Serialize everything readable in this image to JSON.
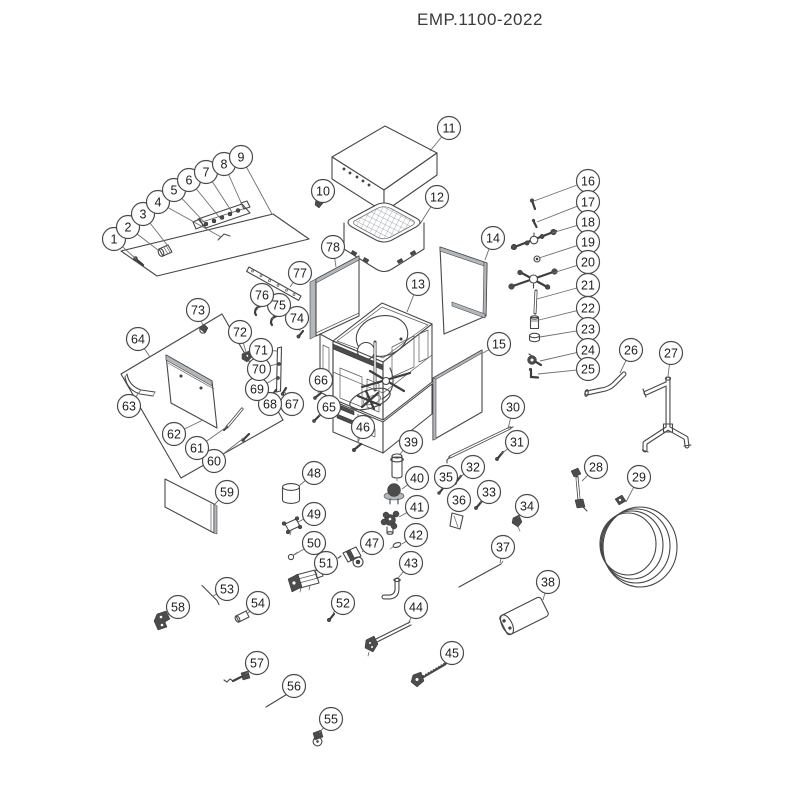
{
  "title": "EMP.1100-2022",
  "diagram": {
    "style": {
      "line_color": "#474747",
      "leader_color": "#6e6e6e",
      "circle_fill": "#ffffff",
      "circle_stroke": "#4a4a4a",
      "number_color": "#1d1d1d",
      "circle_radius": 11.5
    },
    "callouts": [
      {
        "n": "1",
        "x": 114,
        "y": 239,
        "tx": 136,
        "ty": 259
      },
      {
        "n": "2",
        "x": 128,
        "y": 227,
        "tx": 158,
        "ty": 250
      },
      {
        "n": "3",
        "x": 143,
        "y": 214,
        "tx": 168,
        "ty": 246
      },
      {
        "n": "4",
        "x": 158,
        "y": 202,
        "tx": 221,
        "ty": 237
      },
      {
        "n": "5",
        "x": 174,
        "y": 190,
        "tx": 205,
        "ty": 223
      },
      {
        "n": "6",
        "x": 189,
        "y": 180,
        "tx": 220,
        "ty": 218
      },
      {
        "n": "7",
        "x": 206,
        "y": 172,
        "tx": 232,
        "ty": 212
      },
      {
        "n": "8",
        "x": 224,
        "y": 164,
        "tx": 243,
        "ty": 207
      },
      {
        "n": "9",
        "x": 241,
        "y": 157,
        "tx": 272,
        "ty": 214
      },
      {
        "n": "10",
        "x": 323,
        "y": 191,
        "tx": 319,
        "ty": 200
      },
      {
        "n": "11",
        "x": 449,
        "y": 128,
        "tx": 430,
        "ty": 151
      },
      {
        "n": "12",
        "x": 437,
        "y": 197,
        "tx": 420,
        "ty": 224
      },
      {
        "n": "13",
        "x": 418,
        "y": 284,
        "tx": 407,
        "ty": 312
      },
      {
        "n": "14",
        "x": 493,
        "y": 238,
        "tx": 485,
        "ty": 260
      },
      {
        "n": "15",
        "x": 499,
        "y": 344,
        "tx": 483,
        "ty": 353
      },
      {
        "n": "16",
        "x": 588,
        "y": 181,
        "tx": 534,
        "ty": 201
      },
      {
        "n": "17",
        "x": 588,
        "y": 202,
        "tx": 537,
        "ty": 222
      },
      {
        "n": "18",
        "x": 588,
        "y": 222,
        "tx": 552,
        "ty": 233
      },
      {
        "n": "19",
        "x": 588,
        "y": 242,
        "tx": 539,
        "ty": 258
      },
      {
        "n": "20",
        "x": 588,
        "y": 262,
        "tx": 553,
        "ty": 273
      },
      {
        "n": "21",
        "x": 588,
        "y": 285,
        "tx": 537,
        "ty": 299
      },
      {
        "n": "22",
        "x": 588,
        "y": 308,
        "tx": 539,
        "ty": 320
      },
      {
        "n": "23",
        "x": 588,
        "y": 329,
        "tx": 540,
        "ty": 337
      },
      {
        "n": "24",
        "x": 588,
        "y": 350,
        "tx": 540,
        "ty": 361
      },
      {
        "n": "25",
        "x": 588,
        "y": 369,
        "tx": 538,
        "ty": 374
      },
      {
        "n": "26",
        "x": 631,
        "y": 350,
        "tx": 620,
        "ty": 373
      },
      {
        "n": "27",
        "x": 671,
        "y": 353,
        "tx": 668,
        "ty": 376
      },
      {
        "n": "28",
        "x": 596,
        "y": 467,
        "tx": 582,
        "ty": 481
      },
      {
        "n": "29",
        "x": 639,
        "y": 477,
        "tx": 626,
        "ty": 502
      },
      {
        "n": "30",
        "x": 513,
        "y": 407,
        "tx": 508,
        "ty": 429
      },
      {
        "n": "31",
        "x": 517,
        "y": 442,
        "tx": 501,
        "ty": 454
      },
      {
        "n": "32",
        "x": 473,
        "y": 467,
        "tx": 459,
        "ty": 478
      },
      {
        "n": "33",
        "x": 489,
        "y": 492,
        "tx": 480,
        "ty": 503
      },
      {
        "n": "34",
        "x": 527,
        "y": 506,
        "tx": 518,
        "ty": 518
      },
      {
        "n": "35",
        "x": 446,
        "y": 477,
        "tx": 441,
        "ty": 488
      },
      {
        "n": "36",
        "x": 459,
        "y": 500,
        "tx": 456,
        "ty": 512
      },
      {
        "n": "37",
        "x": 503,
        "y": 547,
        "tx": 500,
        "ty": 563
      },
      {
        "n": "38",
        "x": 548,
        "y": 582,
        "tx": 543,
        "ty": 600
      },
      {
        "n": "39",
        "x": 411,
        "y": 442,
        "tx": 399,
        "ty": 455
      },
      {
        "n": "40",
        "x": 417,
        "y": 478,
        "tx": 402,
        "ty": 489
      },
      {
        "n": "41",
        "x": 417,
        "y": 507,
        "tx": 399,
        "ty": 517
      },
      {
        "n": "42",
        "x": 416,
        "y": 535,
        "tx": 402,
        "ty": 544
      },
      {
        "n": "43",
        "x": 411,
        "y": 563,
        "tx": 398,
        "ty": 578
      },
      {
        "n": "44",
        "x": 416,
        "y": 607,
        "tx": 408,
        "ty": 624
      },
      {
        "n": "45",
        "x": 452,
        "y": 653,
        "tx": 445,
        "ty": 663
      },
      {
        "n": "46",
        "x": 363,
        "y": 427,
        "tx": 358,
        "ty": 443
      },
      {
        "n": "47",
        "x": 372,
        "y": 543,
        "tx": 362,
        "ty": 552
      },
      {
        "n": "48",
        "x": 314,
        "y": 473,
        "tx": 299,
        "ty": 486
      },
      {
        "n": "49",
        "x": 314,
        "y": 514,
        "tx": 298,
        "ty": 522
      },
      {
        "n": "50",
        "x": 314,
        "y": 543,
        "tx": 294,
        "ty": 555
      },
      {
        "n": "51",
        "x": 326,
        "y": 563,
        "tx": 314,
        "ty": 572
      },
      {
        "n": "52",
        "x": 343,
        "y": 603,
        "tx": 333,
        "ty": 613
      },
      {
        "n": "53",
        "x": 227,
        "y": 589,
        "tx": 213,
        "ty": 596
      },
      {
        "n": "54",
        "x": 258,
        "y": 603,
        "tx": 248,
        "ty": 613
      },
      {
        "n": "55",
        "x": 331,
        "y": 719,
        "tx": 319,
        "ty": 733
      },
      {
        "n": "56",
        "x": 294,
        "y": 686,
        "tx": 288,
        "ty": 693
      },
      {
        "n": "57",
        "x": 257,
        "y": 663,
        "tx": 246,
        "ty": 674
      },
      {
        "n": "58",
        "x": 178,
        "y": 607,
        "tx": 168,
        "ty": 615
      },
      {
        "n": "59",
        "x": 227,
        "y": 492,
        "tx": 215,
        "ty": 504
      },
      {
        "n": "60",
        "x": 214,
        "y": 461,
        "tx": 245,
        "ty": 437
      },
      {
        "n": "61",
        "x": 197,
        "y": 448,
        "tx": 228,
        "ty": 426
      },
      {
        "n": "62",
        "x": 174,
        "y": 434,
        "tx": 203,
        "ty": 420
      },
      {
        "n": "63",
        "x": 129,
        "y": 406,
        "tx": 141,
        "ty": 390
      },
      {
        "n": "64",
        "x": 138,
        "y": 339,
        "tx": 150,
        "ty": 357
      },
      {
        "n": "65",
        "x": 329,
        "y": 407,
        "tx": 319,
        "ty": 416
      },
      {
        "n": "66",
        "x": 321,
        "y": 380,
        "tx": 318,
        "ty": 393
      },
      {
        "n": "67",
        "x": 292,
        "y": 404,
        "tx": 284,
        "ty": 391
      },
      {
        "n": "68",
        "x": 270,
        "y": 404,
        "tx": 275,
        "ty": 392
      },
      {
        "n": "69",
        "x": 257,
        "y": 389,
        "tx": 276,
        "ty": 378
      },
      {
        "n": "70",
        "x": 259,
        "y": 369,
        "tx": 277,
        "ty": 364
      },
      {
        "n": "71",
        "x": 261,
        "y": 350,
        "tx": 277,
        "ty": 351
      },
      {
        "n": "72",
        "x": 240,
        "y": 332,
        "tx": 246,
        "ty": 352
      },
      {
        "n": "73",
        "x": 198,
        "y": 310,
        "tx": 203,
        "ty": 326
      },
      {
        "n": "74",
        "x": 297,
        "y": 318,
        "tx": 300,
        "ty": 331
      },
      {
        "n": "75",
        "x": 279,
        "y": 305,
        "tx": 272,
        "ty": 319
      },
      {
        "n": "76",
        "x": 262,
        "y": 295,
        "tx": 257,
        "ty": 310
      },
      {
        "n": "77",
        "x": 300,
        "y": 273,
        "tx": 290,
        "ty": 287
      },
      {
        "n": "78",
        "x": 333,
        "y": 247,
        "tx": 336,
        "ty": 267
      }
    ]
  }
}
